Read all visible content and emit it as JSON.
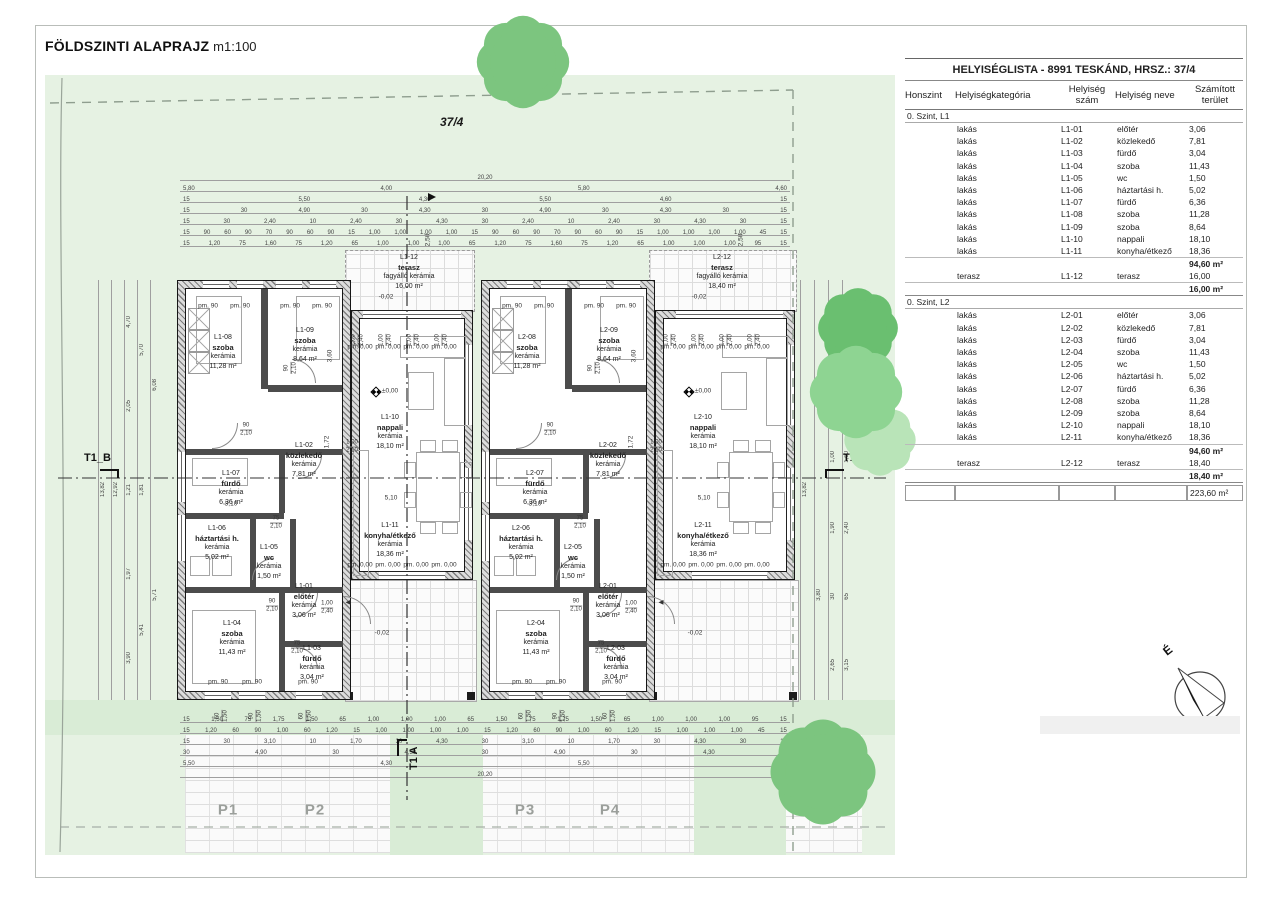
{
  "page": {
    "title": "FÖLDSZINTI ALAPRAJZ",
    "scale": "m1:100"
  },
  "plot": {
    "number": "37/4"
  },
  "markers": {
    "section_b": "T1_B",
    "section_a": "T1 A",
    "north": "É"
  },
  "parking": {
    "labels": [
      "P1",
      "P2",
      "P3",
      "P4"
    ]
  },
  "levels": {
    "zero": "±0,00",
    "minus": "-0,02"
  },
  "marks": {
    "sill": "pm. 0,00",
    "window": "pm. 90",
    "entry_arrow": "◀"
  },
  "inline_dims": {
    "living_width": "5,10",
    "slide_w": "1,00",
    "slide_h": "2,40",
    "door90": "90",
    "door75": "75",
    "door_h": "2,10",
    "entry_h": "2,10",
    "terrace_depth": "2,50",
    "d360": "3,60",
    "d172": "1,72",
    "d310": "3,10"
  },
  "units": [
    {
      "id": "L1",
      "rooms": [
        {
          "num": "L1-08",
          "name": "szoba",
          "mat": "kerámia",
          "area": "11,28 m²"
        },
        {
          "num": "L1-09",
          "name": "szoba",
          "mat": "kerámia",
          "area": "8,64 m²"
        },
        {
          "num": "L1-02",
          "name": "közlekedő",
          "mat": "kerámia",
          "area": "7,81 m²"
        },
        {
          "num": "L1-07",
          "name": "fürdő",
          "mat": "kerámia",
          "area": "6,36 m²"
        },
        {
          "num": "L1-06",
          "name": "háztartási h.",
          "mat": "kerámia",
          "area": "5,02 m²"
        },
        {
          "num": "L1-05",
          "name": "wc",
          "mat": "kerámia",
          "area": "1,50 m²"
        },
        {
          "num": "L1-01",
          "name": "előtér",
          "mat": "kerámia",
          "area": "3,06 m²"
        },
        {
          "num": "L1-04",
          "name": "szoba",
          "mat": "kerámia",
          "area": "11,43 m²"
        },
        {
          "num": "L1-03",
          "name": "fürdő",
          "mat": "kerámia",
          "area": "3,04 m²"
        },
        {
          "num": "L1-10",
          "name": "nappali",
          "mat": "kerámia",
          "area": "18,10 m²"
        },
        {
          "num": "L1-11",
          "name": "konyha/étkező",
          "mat": "kerámia",
          "area": "18,36 m²"
        }
      ],
      "terrace": {
        "num": "L1-12",
        "name": "terasz",
        "mat": "fagyálló kerámia",
        "area": "16,00 m²"
      }
    },
    {
      "id": "L2",
      "rooms": [
        {
          "num": "L2-08",
          "name": "szoba",
          "mat": "kerámia",
          "area": "11,28 m²"
        },
        {
          "num": "L2-09",
          "name": "szoba",
          "mat": "kerámia",
          "area": "8,64 m²"
        },
        {
          "num": "L2-02",
          "name": "közlekedő",
          "mat": "kerámia",
          "area": "7,81 m²"
        },
        {
          "num": "L2-07",
          "name": "fürdő",
          "mat": "kerámia",
          "area": "6,36 m²"
        },
        {
          "num": "L2-06",
          "name": "háztartási h.",
          "mat": "kerámia",
          "area": "5,02 m²"
        },
        {
          "num": "L2-05",
          "name": "wc",
          "mat": "kerámia",
          "area": "1,50 m²"
        },
        {
          "num": "L2-01",
          "name": "előtér",
          "mat": "kerámia",
          "area": "3,06 m²"
        },
        {
          "num": "L2-04",
          "name": "szoba",
          "mat": "kerámia",
          "area": "11,43 m²"
        },
        {
          "num": "L2-03",
          "name": "fürdő",
          "mat": "kerámia",
          "area": "3,04 m²"
        },
        {
          "num": "L2-10",
          "name": "nappali",
          "mat": "kerámia",
          "area": "18,10 m²"
        },
        {
          "num": "L2-11",
          "name": "konyha/étkező",
          "mat": "kerámia",
          "area": "18,36 m²"
        }
      ],
      "terrace": {
        "num": "L2-12",
        "name": "terasz",
        "mat": "fagyálló kerámia",
        "area": "18,40 m²"
      }
    }
  ],
  "dimensions": {
    "top": [
      [
        "20,20"
      ],
      [
        "5,80",
        "4,00",
        "5,80",
        "4,60"
      ],
      [
        "15",
        "5,50",
        "4,30",
        "5,50",
        "4,60",
        "15"
      ],
      [
        "15",
        "30",
        "4,90",
        "30",
        "4,30",
        "30",
        "4,90",
        "30",
        "4,30",
        "30",
        "15"
      ],
      [
        "15",
        "30",
        "2,40",
        "10",
        "2,40",
        "30",
        "4,30",
        "30",
        "2,40",
        "10",
        "2,40",
        "30",
        "4,30",
        "30",
        "15"
      ],
      [
        "15",
        "90",
        "60",
        "90",
        "70",
        "90",
        "60",
        "90",
        "15",
        "1,00",
        "1,00",
        "1,00",
        "1,00",
        "15",
        "90",
        "60",
        "90",
        "70",
        "90",
        "60",
        "90",
        "15",
        "1,00",
        "1,00",
        "1,00",
        "1,00",
        "45",
        "15"
      ],
      [
        "15",
        "1,20",
        "75",
        "1,60",
        "75",
        "1,20",
        "65",
        "1,00",
        "1,00",
        "1,00",
        "65",
        "1,20",
        "75",
        "1,60",
        "75",
        "1,20",
        "65",
        "1,00",
        "1,00",
        "1,00",
        "95",
        "15"
      ]
    ],
    "bottom": [
      [
        "15",
        "1,50",
        "75",
        "1,75",
        "1,50",
        "65",
        "1,00",
        "1,00",
        "1,00",
        "65",
        "1,50",
        "75",
        "1,75",
        "1,50",
        "65",
        "1,00",
        "1,00",
        "1,00",
        "95",
        "15"
      ],
      [
        "15",
        "1,20",
        "60",
        "90",
        "1,00",
        "60",
        "1,20",
        "15",
        "1,00",
        "1,00",
        "1,00",
        "1,00",
        "15",
        "1,20",
        "60",
        "90",
        "1,00",
        "60",
        "1,20",
        "15",
        "1,00",
        "1,00",
        "1,00",
        "45",
        "15"
      ],
      [
        "15",
        "30",
        "3,10",
        "10",
        "1,70",
        "30",
        "4,30",
        "30",
        "3,10",
        "10",
        "1,70",
        "30",
        "4,30",
        "30",
        "15"
      ],
      [
        "30",
        "4,90",
        "30",
        "4,30",
        "30",
        "4,90",
        "30",
        "4,30",
        "30"
      ],
      [
        "5,50",
        "4,30",
        "5,50",
        "4,60"
      ],
      [
        "20,20"
      ]
    ],
    "left_cols": [
      [
        "13,82"
      ],
      [
        "12,92"
      ],
      [
        "4,70",
        "2,05",
        "1,21",
        "1,97",
        "3,90"
      ],
      [
        "5,70",
        "1,81",
        "5,41"
      ],
      [
        "6,08",
        "5,71"
      ]
    ],
    "right_cols": [
      [
        "13,82"
      ],
      [
        "3,50",
        "3,80"
      ],
      [
        "1,20",
        "4,12",
        "1,00",
        "1,90",
        "30",
        "2,65"
      ],
      [
        "1,50",
        "4,82",
        "1,00",
        "2,40",
        "65",
        "3,15"
      ]
    ],
    "window_sills": [
      [
        "60",
        "1,50"
      ],
      [
        "90",
        "1,50"
      ],
      [
        "60",
        "1,50"
      ]
    ]
  },
  "roomlist": {
    "title": "HELYISÉGLISTA - 8991 TESKÁND, HRSZ.: 37/4",
    "columns": [
      "Honszint",
      "Helyiségkategória",
      "Helyiség szám",
      "Helyiség neve",
      "Számított terület"
    ],
    "sections": [
      {
        "group": "0. Szint, L1",
        "rows": [
          [
            "lakás",
            "L1-01",
            "előtér",
            "3,06"
          ],
          [
            "lakás",
            "L1-02",
            "közlekedő",
            "7,81"
          ],
          [
            "lakás",
            "L1-03",
            "fürdő",
            "3,04"
          ],
          [
            "lakás",
            "L1-04",
            "szoba",
            "11,43"
          ],
          [
            "lakás",
            "L1-05",
            "wc",
            "1,50"
          ],
          [
            "lakás",
            "L1-06",
            "háztartási h.",
            "5,02"
          ],
          [
            "lakás",
            "L1-07",
            "fürdő",
            "6,36"
          ],
          [
            "lakás",
            "L1-08",
            "szoba",
            "11,28"
          ],
          [
            "lakás",
            "L1-09",
            "szoba",
            "8,64"
          ],
          [
            "lakás",
            "L1-10",
            "nappali",
            "18,10"
          ],
          [
            "lakás",
            "L1-11",
            "konyha/étkező",
            "18,36"
          ]
        ],
        "subtotal": "94,60 m²",
        "terrace_row": [
          "terasz",
          "L1-12",
          "terasz",
          "16,00"
        ],
        "terrace_total": "16,00 m²"
      },
      {
        "group": "0. Szint, L2",
        "rows": [
          [
            "lakás",
            "L2-01",
            "előtér",
            "3,06"
          ],
          [
            "lakás",
            "L2-02",
            "közlekedő",
            "7,81"
          ],
          [
            "lakás",
            "L2-03",
            "fürdő",
            "3,04"
          ],
          [
            "lakás",
            "L2-04",
            "szoba",
            "11,43"
          ],
          [
            "lakás",
            "L2-05",
            "wc",
            "1,50"
          ],
          [
            "lakás",
            "L2-06",
            "háztartási h.",
            "5,02"
          ],
          [
            "lakás",
            "L2-07",
            "fürdő",
            "6,36"
          ],
          [
            "lakás",
            "L2-08",
            "szoba",
            "11,28"
          ],
          [
            "lakás",
            "L2-09",
            "szoba",
            "8,64"
          ],
          [
            "lakás",
            "L2-10",
            "nappali",
            "18,10"
          ],
          [
            "lakás",
            "L2-11",
            "konyha/étkező",
            "18,36"
          ]
        ],
        "subtotal": "94,60 m²",
        "terrace_row": [
          "terasz",
          "L2-12",
          "terasz",
          "18,40"
        ],
        "terrace_total": "18,40 m²"
      }
    ],
    "grand_total": "223,60 m²"
  }
}
